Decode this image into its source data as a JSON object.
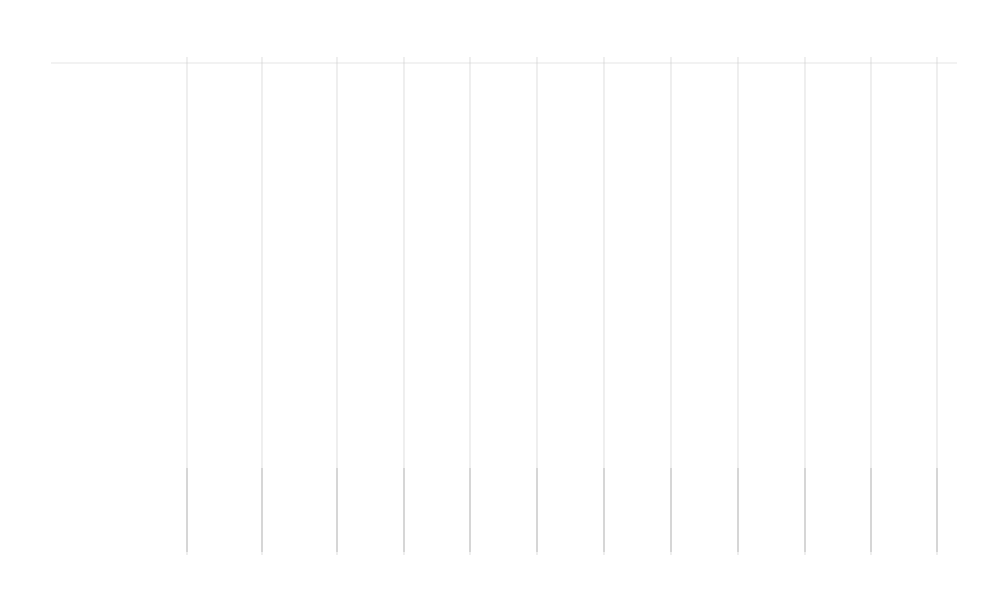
{
  "drawing": {
    "axes_bottom": [
      [
        "1",
        187
      ],
      [
        "2",
        262
      ],
      [
        "3",
        337
      ],
      [
        "4",
        404
      ],
      [
        "5",
        470
      ],
      [
        "6",
        537
      ],
      [
        "7",
        604
      ],
      [
        "8",
        671
      ],
      [
        "9",
        738
      ],
      [
        "10",
        805
      ],
      [
        "11",
        871
      ],
      [
        "12",
        937
      ]
    ],
    "axes_left": [
      [
        "Г",
        63
      ],
      [
        "В",
        230
      ],
      [
        "Б",
        297
      ],
      [
        "А",
        465
      ]
    ],
    "dims_bottom": [
      [
        "2660",
        224.5
      ],
      [
        "2670",
        299.5
      ],
      [
        "2450",
        370.5
      ],
      [
        "2450",
        437
      ],
      [
        "2450",
        503.5
      ],
      [
        "2450",
        570.5
      ],
      [
        "2450",
        637.5
      ],
      [
        "2450",
        704.5
      ],
      [
        "2450",
        771.5
      ],
      [
        "2450",
        838
      ],
      [
        "2440",
        904
      ]
    ],
    "dim_bottom_total": "27370",
    "dims_left": [
      [
        "6060",
        146.5
      ],
      [
        "2450",
        263.5
      ],
      [
        "6060",
        381
      ]
    ],
    "dim_left_total": "14570",
    "rooms": [
      {
        "num": "105",
        "x": 225,
        "y": 145,
        "name": [
          "Энергетич-й",
          "модуль"
        ]
      },
      {
        "num": "106",
        "x": 297,
        "y": 145,
        "name": [
          "Экологич-й",
          "модуль"
        ]
      },
      {
        "num": "107",
        "x": 370,
        "y": 145,
        "name": [
          "Санузел"
        ]
      },
      {
        "num": "108",
        "x": 437,
        "y": 147,
        "name": [
          "Санитарный",
          "модуль"
        ]
      },
      {
        "num": "108Б",
        "x": 416,
        "y": 97,
        "name": [
          "Пом-е",
          "запаса",
          "Воды"
        ],
        "tx": 443,
        "ty": 88
      },
      {
        "num": "110",
        "x": 506,
        "y": 145,
        "name": [
          "Жилой",
          "модуль"
        ]
      },
      {
        "num": "111",
        "x": 573,
        "y": 145,
        "name": [
          "Жилой",
          "модуль"
        ]
      },
      {
        "num": "112",
        "x": 640,
        "y": 145,
        "name": [
          "Жилой",
          "модуль"
        ]
      },
      {
        "num": "113",
        "x": 707,
        "y": 145,
        "name": [
          "Жилой",
          "модуль"
        ]
      },
      {
        "num": "101",
        "x": 775,
        "y": 97,
        "name": [
          "Тамбур"
        ],
        "off": 15
      },
      {
        "num": "101.1",
        "x": 774,
        "y": 182,
        "name": [
          "Тамбур"
        ],
        "off": 15
      },
      {
        "num": "124",
        "x": 843,
        "y": 148,
        "name": [
          "Гардероб"
        ],
        "off": 21
      },
      {
        "num": "125",
        "x": 914,
        "y": 93,
        "name": [
          "ЛК"
        ],
        "off": 22
      },
      {
        "num": "104/1",
        "x": 229,
        "y": 258,
        "name": [
          "Электрощ-я"
        ],
        "off": 23
      },
      {
        "num": "104",
        "x": 297,
        "y": 258,
        "name": [
          "Тамбур"
        ],
        "off": 15
      },
      {
        "num": "103",
        "x": 423,
        "y": 258,
        "name": [
          "Коридор"
        ],
        "off": 16
      },
      {
        "num": "102",
        "x": 698,
        "y": 258,
        "name": [
          "Коридор"
        ],
        "off": 15
      },
      {
        "num": "104/3",
        "x": 230,
        "y": 324,
        "name": [
          "Вент.",
          "камера"
        ],
        "off": 16
      },
      {
        "num": "104/2",
        "x": 297,
        "y": 324,
        "name": [
          "Тамбур"
        ],
        "off": 15
      },
      {
        "num": "115",
        "x": 372,
        "y": 382,
        "name": [
          "Буфет"
        ],
        "off": 15
      },
      {
        "num": "116",
        "x": 438,
        "y": 382,
        "name": [
          "Помещение",
          "приема",
          "пищи"
        ],
        "off": 16
      },
      {
        "num": "117",
        "x": 505,
        "y": 382,
        "name": [
          "Жилой",
          "модуль"
        ]
      },
      {
        "num": "118",
        "x": 572,
        "y": 382,
        "name": [
          "Жилой",
          "модуль"
        ]
      },
      {
        "num": "119",
        "x": 638,
        "y": 382,
        "name": [
          "Жилой",
          "модуль"
        ]
      },
      {
        "num": "120",
        "x": 709,
        "y": 382,
        "name": [
          "Жилой",
          "модуль"
        ]
      },
      {
        "num": "121",
        "x": 775,
        "y": 382,
        "name": [
          "Жилой",
          "модуль"
        ]
      },
      {
        "num": "122",
        "x": 842,
        "y": 382,
        "name": [
          "Жилой",
          "модуль"
        ]
      },
      {
        "num": "123",
        "x": 908,
        "y": 382,
        "name": [
          "Склад со",
          "стеллажами"
        ],
        "off": 16
      }
    ],
    "tags": [
      [
        "ОК2",
        370,
        77
      ],
      [
        "ОК1",
        438,
        78
      ],
      [
        "ОК1",
        506,
        78
      ],
      [
        "ОК1",
        573,
        78
      ],
      [
        "ОК1",
        640,
        78
      ],
      [
        "ОК1",
        707,
        78
      ],
      [
        "ОК1",
        843,
        78
      ],
      [
        "Д1",
        790,
        78
      ],
      [
        "Д2",
        301,
        72
      ],
      [
        "Д3",
        199,
        120
      ],
      [
        "Д8",
        455,
        134
      ],
      [
        "Д6.1",
        777,
        129
      ],
      [
        "Д7.1",
        799,
        170
      ],
      [
        "Д6.1",
        777,
        218
      ],
      [
        "Д6",
        912,
        219
      ],
      [
        "Д7.1",
        240,
        221
      ],
      [
        "Д7.1",
        293,
        221
      ],
      [
        "Д8.1",
        370,
        217
      ],
      [
        "Д8.1",
        437,
        217
      ],
      [
        "Д8.1",
        506,
        217
      ],
      [
        "Д8.1",
        573,
        217
      ],
      [
        "Д8.1",
        640,
        217
      ],
      [
        "Д8.1",
        707,
        217
      ],
      [
        "Д7.1",
        254,
        271
      ],
      [
        "Д6.1",
        302,
        291
      ],
      [
        "Д5.1",
        347,
        266
      ],
      [
        "Д5",
        485,
        265
      ],
      [
        "Д7.1",
        254,
        333
      ],
      [
        "Д4",
        318,
        352
      ],
      [
        "Д8",
        370,
        312
      ],
      [
        "Д8.1",
        438,
        311
      ],
      [
        "Д8.1",
        505,
        311
      ],
      [
        "Д8.1",
        572,
        311
      ],
      [
        "Д8.1",
        641,
        311
      ],
      [
        "Д8.1",
        708,
        311
      ],
      [
        "Д8.1",
        775,
        311
      ],
      [
        "Д8.1",
        841,
        311
      ],
      [
        "Д8.1",
        908,
        311
      ],
      [
        "ОК2",
        368,
        453
      ],
      [
        "ОК1",
        438,
        454
      ],
      [
        "ОК1",
        505,
        454
      ],
      [
        "ОК1",
        571,
        454
      ],
      [
        "ОК1",
        638,
        454
      ],
      [
        "ОК1",
        709,
        454
      ],
      [
        "ОК1",
        777,
        454
      ],
      [
        "ОК1",
        844,
        454
      ],
      [
        "ОК1",
        912,
        454
      ],
      [
        "ОК2",
        930,
        264
      ]
    ],
    "stair": {
      "note": "10x145/300",
      "width_dim": "1000",
      "level": "0,000"
    },
    "section_marks": {
      "cut_1": "1",
      "cut_2": "2(5)"
    },
    "colors": {
      "wall": "#1b1b1b",
      "grid": "#c9c9c9",
      "room_name": "#b9b9b9",
      "door_arc": "#666666",
      "red_mark": "#cc2222",
      "grip_blue": "#2e7bd8",
      "frame": "#d0d0d0"
    }
  }
}
